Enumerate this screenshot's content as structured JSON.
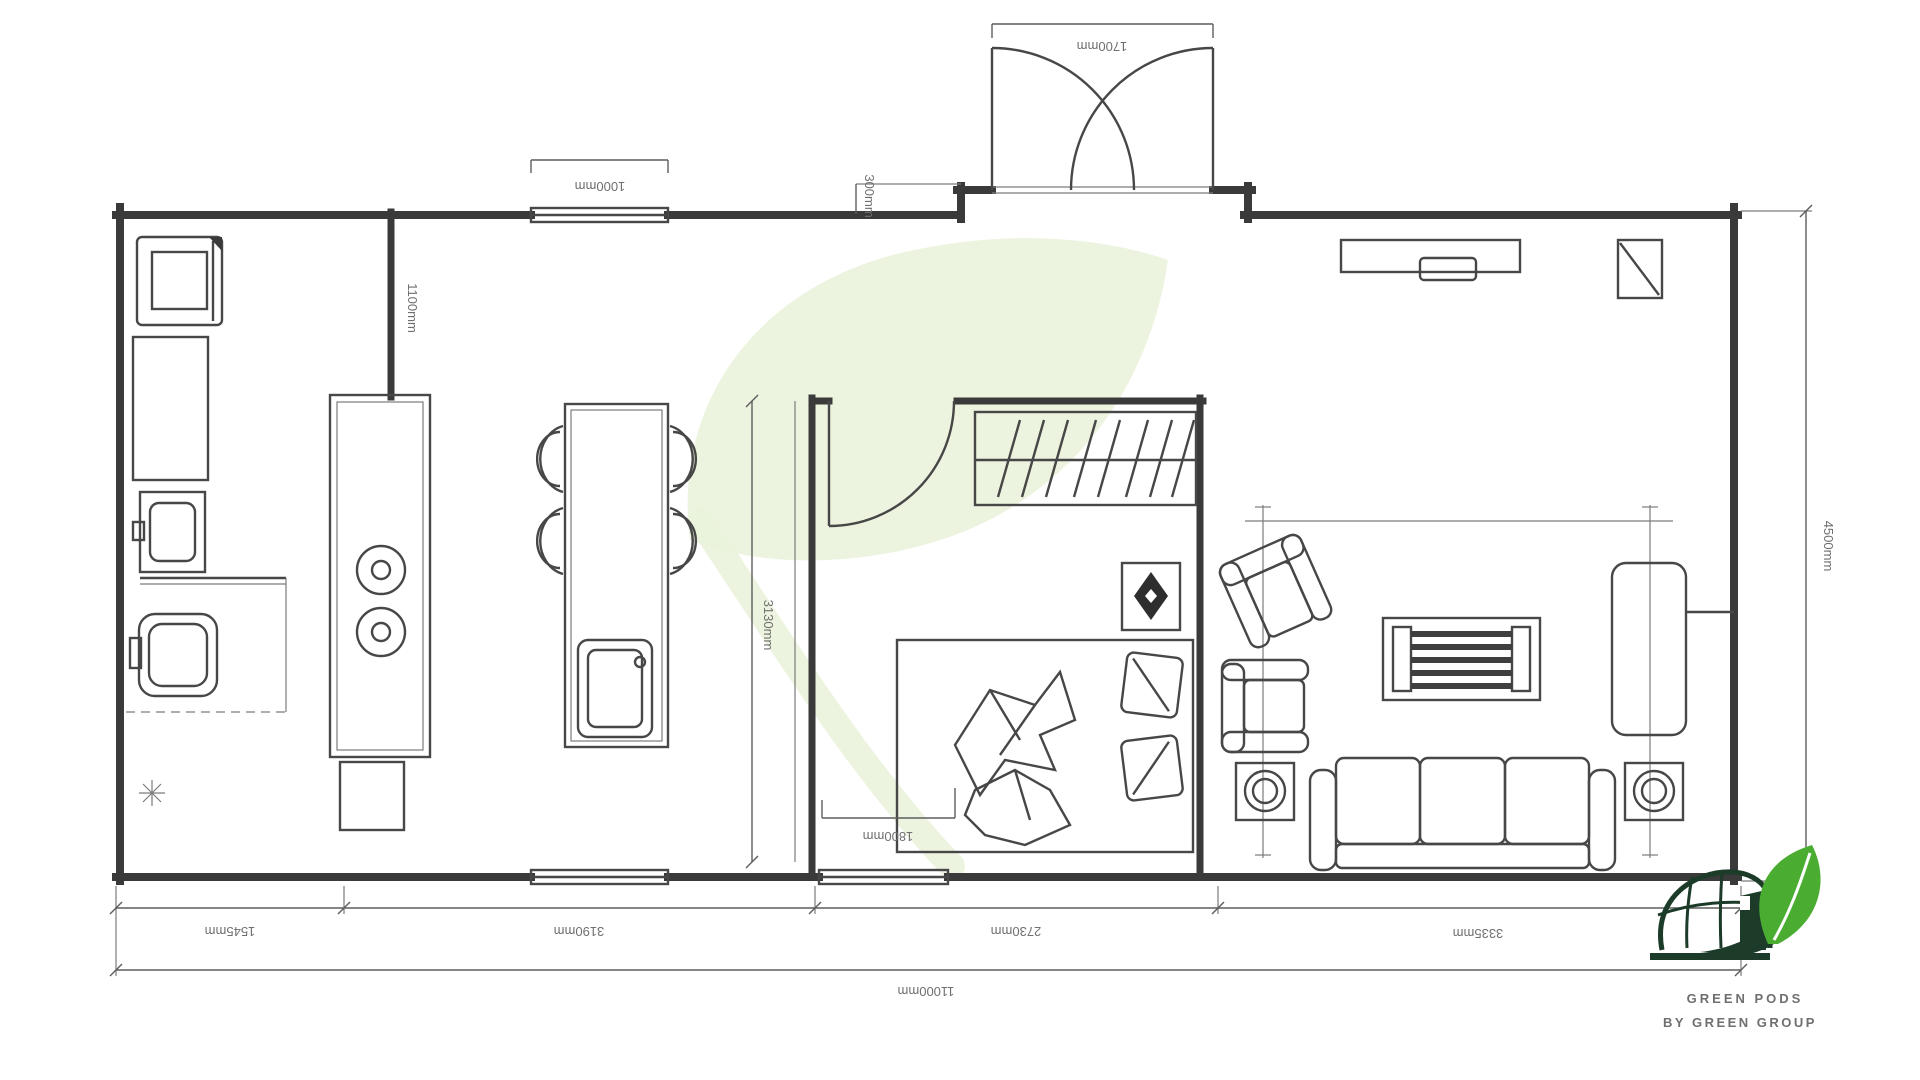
{
  "drawing": {
    "type": "floor-plan",
    "units": "mm",
    "dimensions": {
      "entry_door": "1700mm",
      "top_window": "1000mm",
      "recess_depth": "300mm",
      "kitchen_wall": "1100mm",
      "dining_length": "3130mm",
      "bed_width": "1800mm",
      "overall_depth": "4500mm",
      "bathroom_width": "1545mm",
      "kitchen_width": "3190mm",
      "bedroom_width": "2730mm",
      "living_width": "3335mm",
      "overall_width": "11000mm"
    }
  },
  "logo": {
    "name": "GREEN PODS",
    "tagline": "BY GREEN GROUP",
    "brand_dark_green": "#1d3b29",
    "brand_leaf_green": "#4aad32"
  },
  "colors": {
    "plan_line": "#3a3a3a",
    "dimension_text": "#6f6f6f",
    "watermark_green": "#eaf3db",
    "background": "#ffffff"
  }
}
